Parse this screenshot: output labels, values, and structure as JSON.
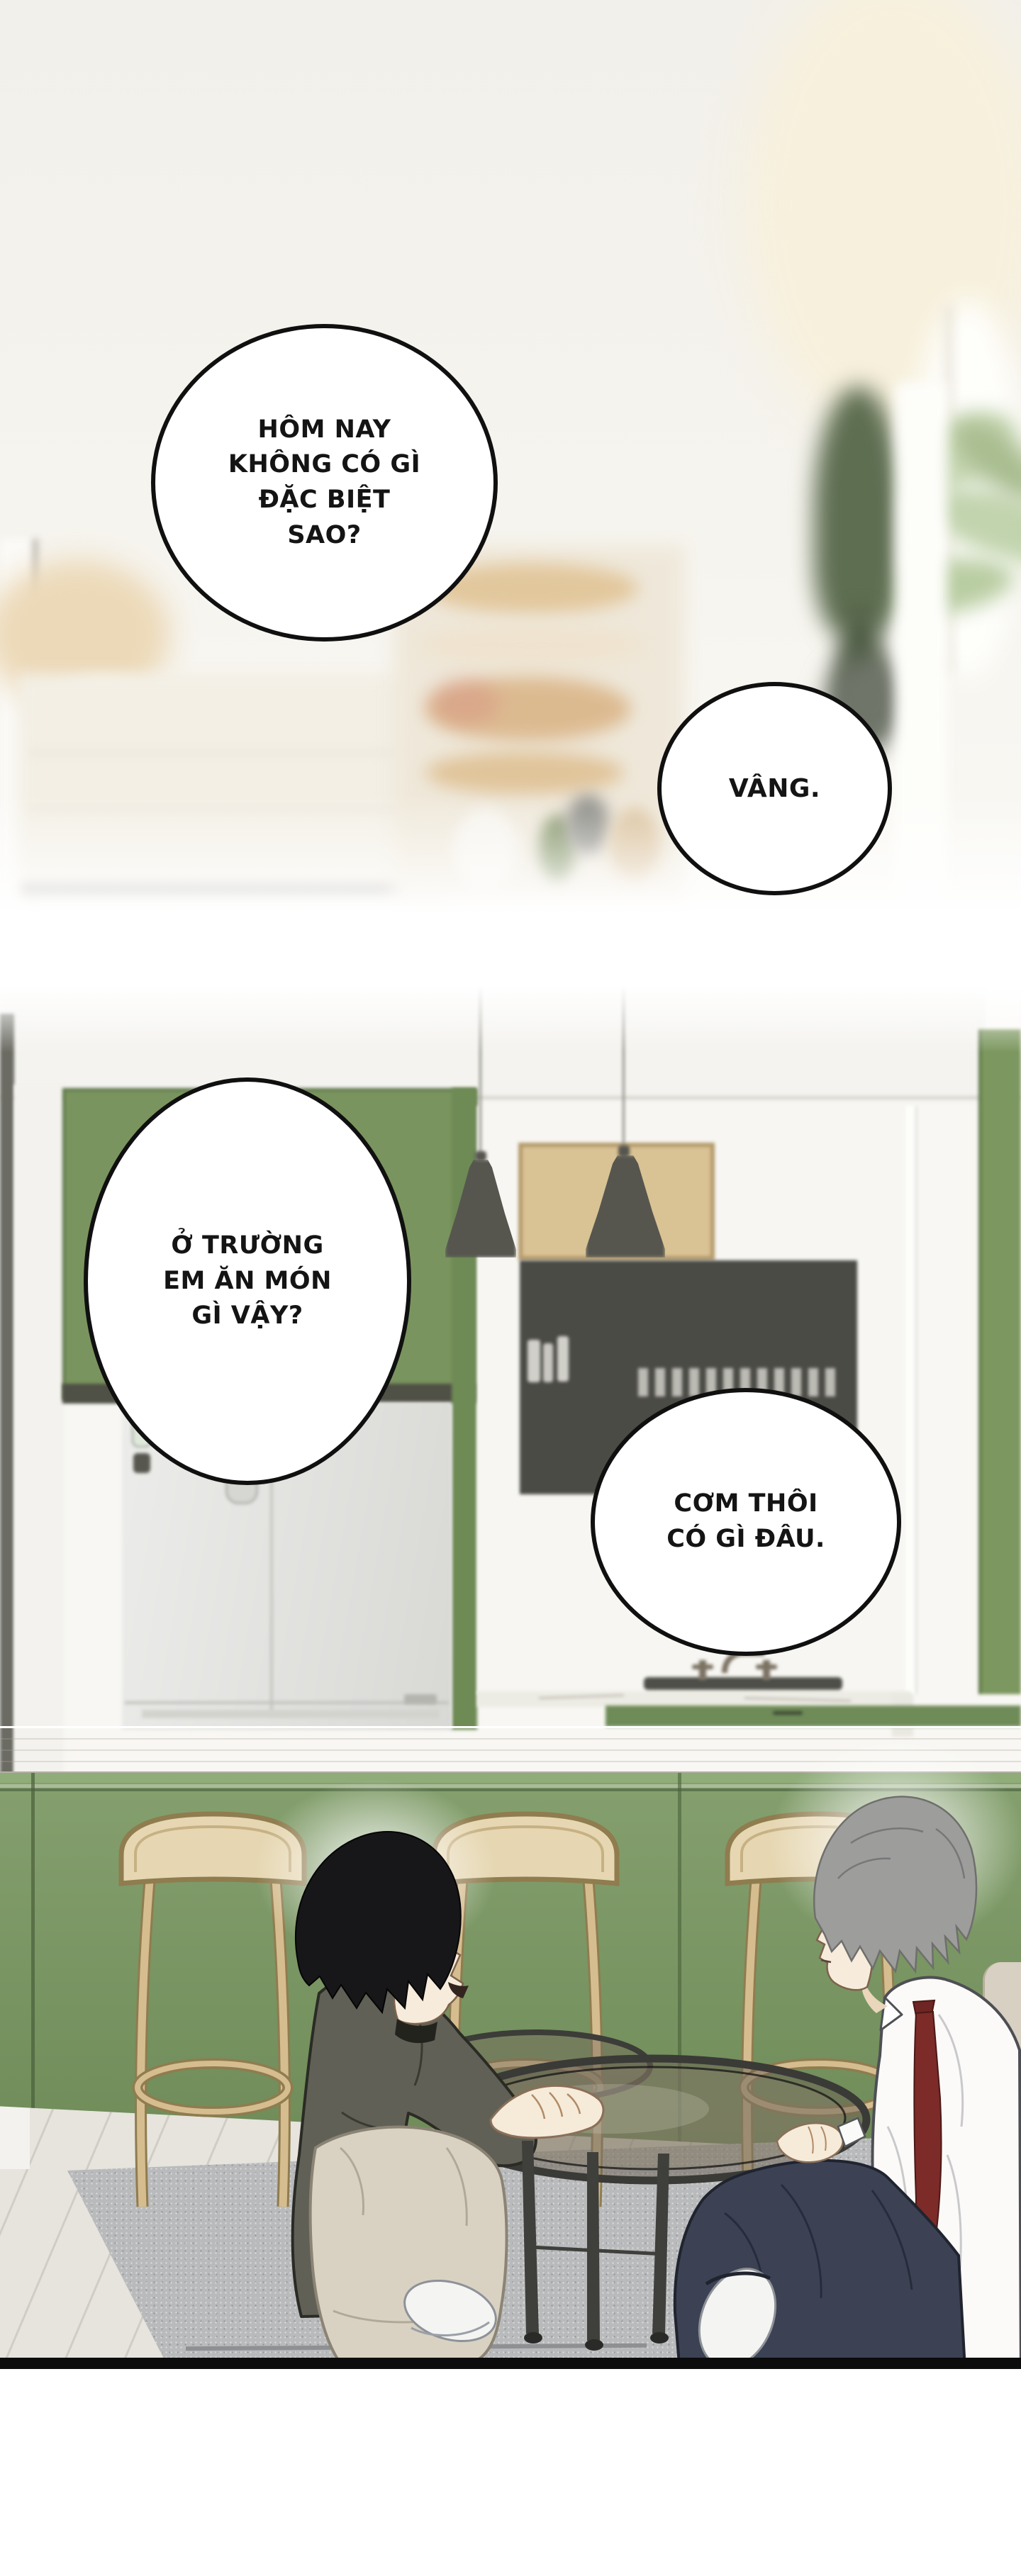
{
  "comic": {
    "title": "manhwa page - kitchen conversation",
    "panel1": {
      "scene": "blurred bright pantry shelves with plant",
      "bubbles": [
        {
          "text": "HÔM NAY\nKHÔNG CÓ GÌ\nĐẶC BIỆT\nSAO?"
        },
        {
          "text": "VÂNG."
        }
      ]
    },
    "panel2": {
      "scene": "green kitchen bar, two characters sitting at low glass table",
      "bubbles": [
        {
          "text": "Ở TRƯỜNG\nEM ĂN MÓN\nGÌ VẬY?"
        },
        {
          "text": "CƠM THÔI\nCÓ GÌ ĐÂU."
        }
      ]
    },
    "colors": {
      "bubble_border": "#101010",
      "cabinet_green": "#7a945f",
      "bar_green": "#7d9a68",
      "stool_tan": "#e6d7b2",
      "fridge_gray": "#e6e6e3",
      "pegboard_tan": "#d9c294",
      "tie_red": "#7c2b28",
      "hair_black": "#17171a",
      "hair_gray": "#9d9d9b",
      "shirt_white": "#fbfaf8",
      "pants_navy": "#3c4254",
      "pants_beige": "#d9d2c3",
      "rug_gray": "#b9babb",
      "floor_wood": "#e6e4dd",
      "panel_border": "#0c0c0c"
    }
  }
}
